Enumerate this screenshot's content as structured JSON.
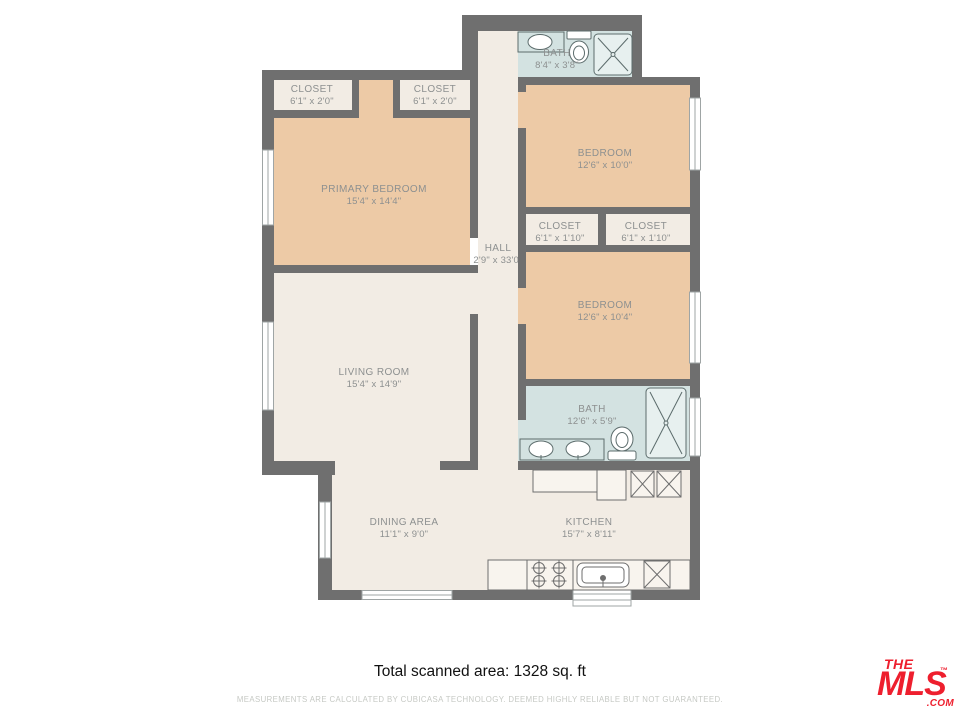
{
  "plan": {
    "rooms": [
      {
        "name": "BATH",
        "dims": "8'4\" x 3'8\""
      },
      {
        "name": "CLOSET",
        "dims": "6'1\" x 2'0\""
      },
      {
        "name": "CLOSET",
        "dims": "6'1\" x 2'0\""
      },
      {
        "name": "PRIMARY BEDROOM",
        "dims": "15'4\" x 14'4\""
      },
      {
        "name": "BEDROOM",
        "dims": "12'6\" x 10'0\""
      },
      {
        "name": "CLOSET",
        "dims": "6'1\" x 1'10\""
      },
      {
        "name": "CLOSET",
        "dims": "6'1\" x 1'10\""
      },
      {
        "name": "HALL",
        "dims": "2'9\" x 33'0\""
      },
      {
        "name": "BEDROOM",
        "dims": "12'6\" x 10'4\""
      },
      {
        "name": "LIVING ROOM",
        "dims": "15'4\" x 14'9\""
      },
      {
        "name": "BATH",
        "dims": "12'6\" x 5'9\""
      },
      {
        "name": "DINING AREA",
        "dims": "11'1\" x 9'0\""
      },
      {
        "name": "KITCHEN",
        "dims": "15'7\" x 8'11\""
      }
    ]
  },
  "footer": {
    "total_area": "Total scanned area: 1328 sq. ft",
    "disclaimer": "MEASUREMENTS ARE CALCULATED BY CUBICASA TECHNOLOGY. DEEMED HIGHLY RELIABLE BUT NOT GUARANTEED."
  },
  "logo": {
    "the": "THE",
    "mls": "MLS",
    "tm": "™",
    "com": ".COM"
  },
  "colors": {
    "wall": "#6f6f6f",
    "bedroom_floor": "#edcaa6",
    "common_floor": "#f2ece4",
    "bath_floor": "#d3e2e1",
    "label_text": "#8d9090",
    "logo_red": "#ee1f2e"
  }
}
